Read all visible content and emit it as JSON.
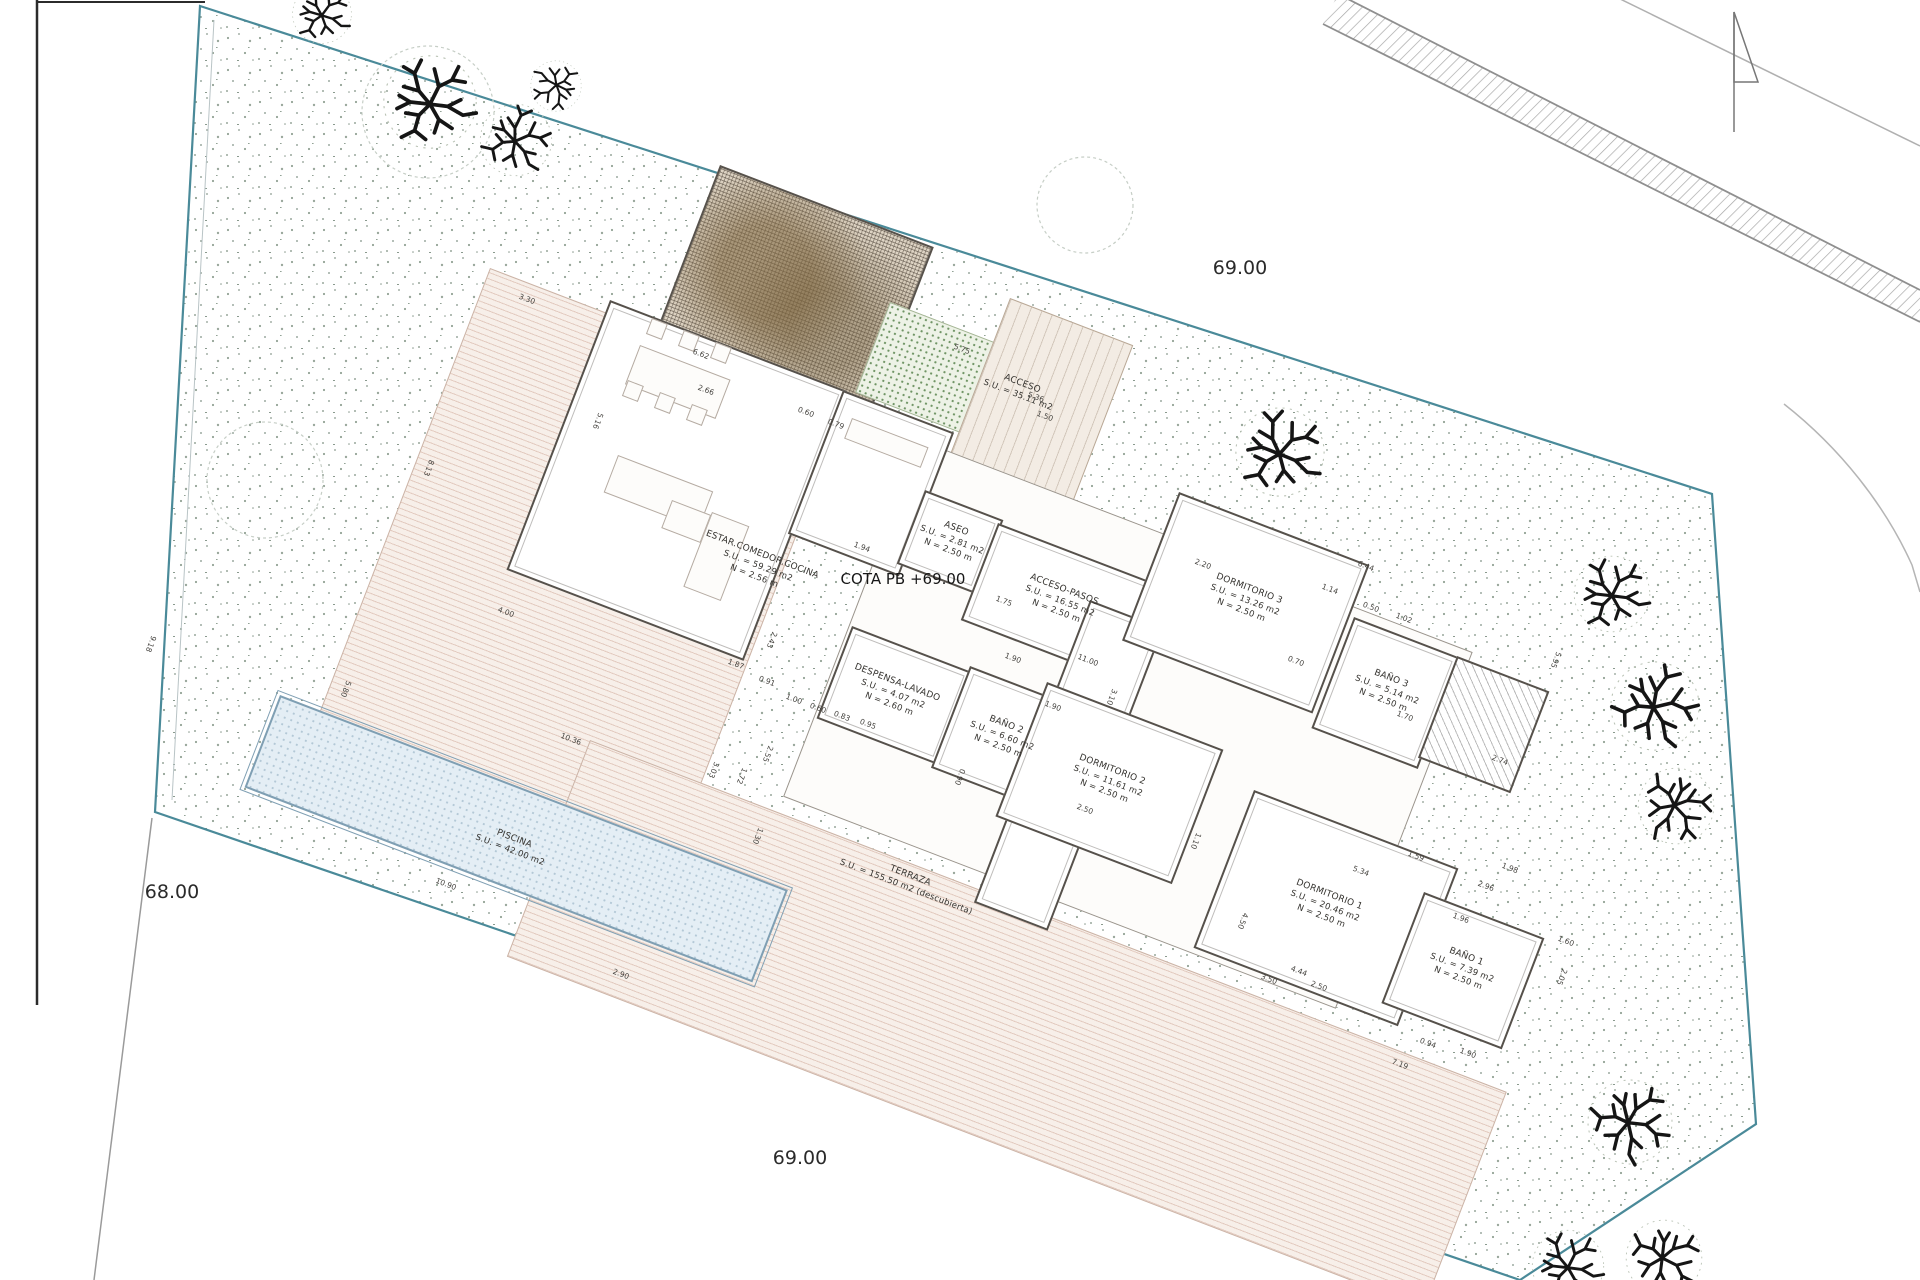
{
  "site": {
    "levels": {
      "top": "69.00",
      "left": "68.00",
      "bottom": "69.00"
    },
    "cota_label": "COTA PB +69.00"
  },
  "colors": {
    "parcel_boundary": "#4a8a99",
    "walls": "#56514b",
    "deck": "#f7efe9",
    "pool": "#e4eef5",
    "green": "#edf2e6",
    "tree": "#151515"
  },
  "icons": {
    "north": "north-arrow-icon",
    "tree": "tree-icon"
  },
  "rooms": [
    {
      "id": "estar",
      "x": 758,
      "y": 566,
      "lines": [
        "ESTAR.COMEDOR.COCINA",
        "S.U. = 59.29 m2",
        "N = 2.56 m"
      ]
    },
    {
      "id": "aseo",
      "x": 952,
      "y": 540,
      "lines": [
        "ASEO",
        "S.U. = 2.81 m2",
        "N = 2.50 m"
      ]
    },
    {
      "id": "acceso-pasos",
      "x": 1060,
      "y": 601,
      "lines": [
        "ACCESO-PASOS",
        "S.U. = 16.55 m2",
        "N = 2.50 m"
      ]
    },
    {
      "id": "acceso",
      "x": 1020,
      "y": 390,
      "lines": [
        "ACCESO",
        "S.U. = 35.11 m2"
      ]
    },
    {
      "id": "dormitorio-3",
      "x": 1245,
      "y": 600,
      "lines": [
        "DORMITORIO 3",
        "S.U. = 13.26 m2",
        "N = 2.50 m"
      ]
    },
    {
      "id": "bano-3",
      "x": 1387,
      "y": 690,
      "lines": [
        "BAÑO 3",
        "S.U. = 5.14 m2",
        "N = 2.50 m"
      ]
    },
    {
      "id": "despensa-lavado",
      "x": 893,
      "y": 694,
      "lines": [
        "DESPENSA-LAVADO",
        "S.U. = 4.07 m2",
        "N = 2.60 m"
      ]
    },
    {
      "id": "bano-2",
      "x": 1002,
      "y": 736,
      "lines": [
        "BAÑO 2",
        "S.U. = 6.60 m2",
        "N = 2.50 m"
      ]
    },
    {
      "id": "dormitorio-2",
      "x": 1108,
      "y": 781,
      "lines": [
        "DORMITORIO 2",
        "S.U. = 11.61 m2",
        "N = 2.50 m"
      ]
    },
    {
      "id": "dormitorio-1",
      "x": 1325,
      "y": 906,
      "lines": [
        "DORMITORIO 1",
        "S.U. = 20.46 m2",
        "N = 2.50 m"
      ]
    },
    {
      "id": "bano-1",
      "x": 1462,
      "y": 968,
      "lines": [
        "BAÑO 1",
        "S.U. = 7.39 m2",
        "N = 2.50 m"
      ]
    },
    {
      "id": "piscina",
      "x": 512,
      "y": 845,
      "lines": [
        "PISCINA",
        "S.U. = 42.00 m2"
      ]
    },
    {
      "id": "terraza",
      "x": 908,
      "y": 882,
      "lines": [
        "TERRAZA",
        "S.U. = 155.50 m2 (descubierta)"
      ]
    }
  ],
  "dimensions": [
    {
      "t": "3.30",
      "x": 527,
      "y": 299,
      "o": "a"
    },
    {
      "t": "6.62",
      "x": 701,
      "y": 354,
      "o": "a"
    },
    {
      "t": "2.66",
      "x": 706,
      "y": 390,
      "o": "a"
    },
    {
      "t": "0.60",
      "x": 806,
      "y": 412,
      "o": "a"
    },
    {
      "t": "0.79",
      "x": 836,
      "y": 424,
      "o": "a"
    },
    {
      "t": "5.75",
      "x": 962,
      "y": 349,
      "o": "a"
    },
    {
      "t": "5.36",
      "x": 1036,
      "y": 397,
      "o": "a"
    },
    {
      "t": "1.50",
      "x": 1045,
      "y": 416,
      "o": "a"
    },
    {
      "t": "8.13",
      "x": 429,
      "y": 468,
      "o": "p"
    },
    {
      "t": "5.16",
      "x": 598,
      "y": 421,
      "o": "p"
    },
    {
      "t": "4.00",
      "x": 506,
      "y": 612,
      "o": "a"
    },
    {
      "t": "9.18",
      "x": 151,
      "y": 644,
      "o": "p"
    },
    {
      "t": "5.80",
      "x": 346,
      "y": 689,
      "o": "p"
    },
    {
      "t": "10.36",
      "x": 571,
      "y": 739,
      "o": "a"
    },
    {
      "t": "10.90",
      "x": 446,
      "y": 884,
      "o": "a"
    },
    {
      "t": "2.90",
      "x": 621,
      "y": 974,
      "o": "a"
    },
    {
      "t": "1.87",
      "x": 736,
      "y": 664,
      "o": "a"
    },
    {
      "t": "0.91",
      "x": 767,
      "y": 681,
      "o": "a"
    },
    {
      "t": "1.00",
      "x": 794,
      "y": 699,
      "o": "a"
    },
    {
      "t": "0.60",
      "x": 818,
      "y": 708,
      "o": "a"
    },
    {
      "t": "0.83",
      "x": 842,
      "y": 716,
      "o": "a"
    },
    {
      "t": "0.95",
      "x": 868,
      "y": 724,
      "o": "a"
    },
    {
      "t": "1.94",
      "x": 862,
      "y": 547,
      "o": "a"
    },
    {
      "t": "1.75",
      "x": 1004,
      "y": 601,
      "o": "a"
    },
    {
      "t": "1.90",
      "x": 1013,
      "y": 658,
      "o": "a"
    },
    {
      "t": "11.00",
      "x": 1088,
      "y": 660,
      "o": "a"
    },
    {
      "t": "3.10",
      "x": 1112,
      "y": 697,
      "o": "p"
    },
    {
      "t": "1.90",
      "x": 1053,
      "y": 706,
      "o": "a"
    },
    {
      "t": "0.90",
      "x": 960,
      "y": 777,
      "o": "p"
    },
    {
      "t": "2.50",
      "x": 1085,
      "y": 809,
      "o": "a"
    },
    {
      "t": "2.20",
      "x": 1203,
      "y": 564,
      "o": "a"
    },
    {
      "t": "1.14",
      "x": 1330,
      "y": 589,
      "o": "a"
    },
    {
      "t": "0.50",
      "x": 1371,
      "y": 607,
      "o": "a"
    },
    {
      "t": "1.02",
      "x": 1404,
      "y": 618,
      "o": "a"
    },
    {
      "t": "0.70",
      "x": 1296,
      "y": 661,
      "o": "a"
    },
    {
      "t": "1.70",
      "x": 1405,
      "y": 716,
      "o": "a"
    },
    {
      "t": "2.74",
      "x": 1500,
      "y": 760,
      "o": "a"
    },
    {
      "t": "5.95",
      "x": 1556,
      "y": 660,
      "o": "p"
    },
    {
      "t": "6.44",
      "x": 1366,
      "y": 566,
      "o": "a"
    },
    {
      "t": "5.34",
      "x": 1361,
      "y": 871,
      "o": "a"
    },
    {
      "t": "1.59",
      "x": 1416,
      "y": 856,
      "o": "a"
    },
    {
      "t": "4.50",
      "x": 1243,
      "y": 921,
      "o": "p"
    },
    {
      "t": "4.44",
      "x": 1299,
      "y": 971,
      "o": "a"
    },
    {
      "t": "3.50",
      "x": 1269,
      "y": 979,
      "o": "a"
    },
    {
      "t": "7.19",
      "x": 1400,
      "y": 1064,
      "o": "a"
    },
    {
      "t": "0.94",
      "x": 1428,
      "y": 1043,
      "o": "a"
    },
    {
      "t": "1.90",
      "x": 1468,
      "y": 1053,
      "o": "a"
    },
    {
      "t": "2.96",
      "x": 1486,
      "y": 886,
      "o": "a"
    },
    {
      "t": "1.96",
      "x": 1461,
      "y": 918,
      "o": "a"
    },
    {
      "t": "1.60",
      "x": 1566,
      "y": 941,
      "o": "a"
    },
    {
      "t": "2.05",
      "x": 1562,
      "y": 977,
      "o": "p"
    },
    {
      "t": "2.55",
      "x": 768,
      "y": 754,
      "o": "p"
    },
    {
      "t": "3.03",
      "x": 714,
      "y": 770,
      "o": "p"
    },
    {
      "t": "1.72",
      "x": 742,
      "y": 776,
      "o": "p"
    },
    {
      "t": "1.30",
      "x": 758,
      "y": 836,
      "o": "p"
    },
    {
      "t": "2.43",
      "x": 772,
      "y": 640,
      "o": "p"
    },
    {
      "t": "1.10",
      "x": 1196,
      "y": 841,
      "o": "p"
    },
    {
      "t": "1.98",
      "x": 1510,
      "y": 868,
      "o": "a"
    },
    {
      "t": "2.50",
      "x": 1319,
      "y": 986,
      "o": "a"
    }
  ]
}
